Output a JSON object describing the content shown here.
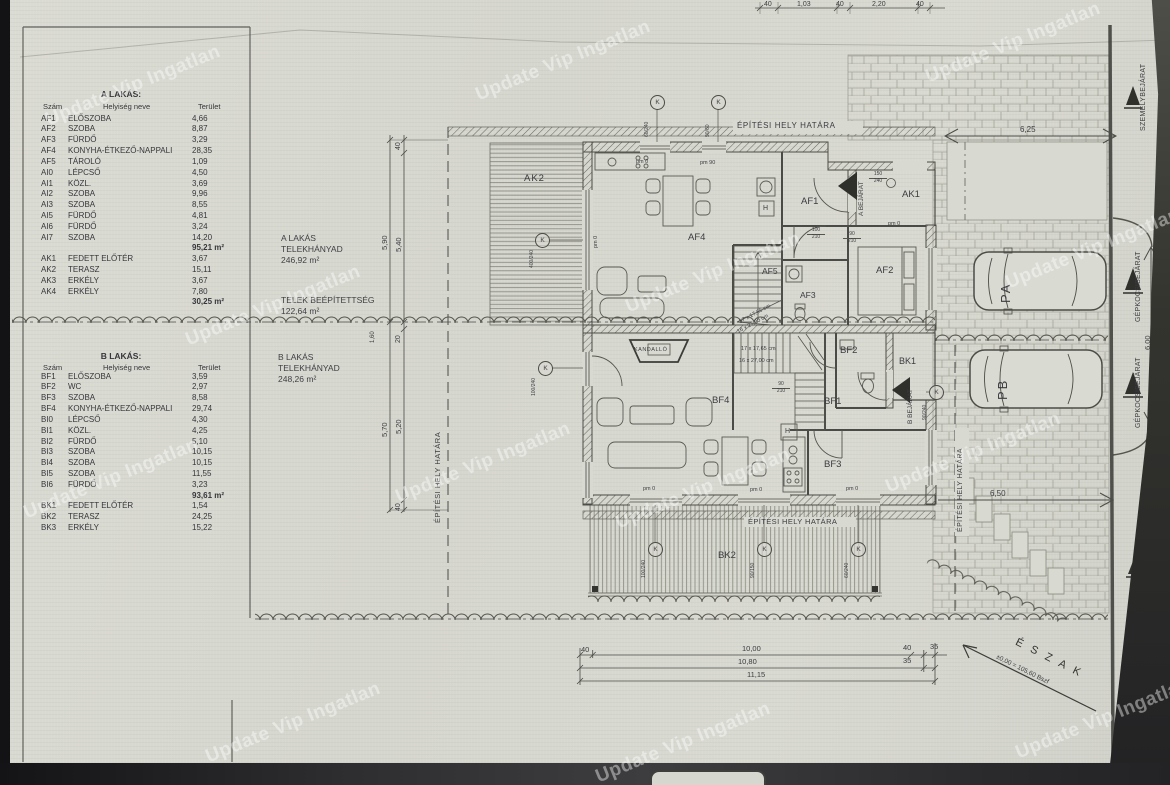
{
  "watermark": "Update Vip Ingatlan",
  "tables": {
    "a": {
      "title": "A LAKÁS:",
      "headers": {
        "num": "Szám",
        "name": "Helyiség neve",
        "area": "Terület"
      },
      "rows": [
        {
          "c": "AF1",
          "n": "ELŐSZOBA",
          "a": "4,66"
        },
        {
          "c": "AF2",
          "n": "SZOBA",
          "a": "8,87"
        },
        {
          "c": "AF3",
          "n": "FÜRDŐ",
          "a": "3,29"
        },
        {
          "c": "AF4",
          "n": "KONYHA-ÉTKEZŐ-NAPPALI",
          "a": "28,35"
        },
        {
          "c": "AF5",
          "n": "TÁROLÓ",
          "a": "1,09"
        },
        {
          "c": "AI0",
          "n": "LÉPCSŐ",
          "a": "4,50"
        },
        {
          "c": "AI1",
          "n": "KÖZL.",
          "a": "3,69"
        },
        {
          "c": "AI2",
          "n": "SZOBA",
          "a": "9,96"
        },
        {
          "c": "AI3",
          "n": "SZOBA",
          "a": "8,55"
        },
        {
          "c": "AI5",
          "n": "FÜRDŐ",
          "a": "4,81"
        },
        {
          "c": "AI6",
          "n": "FÜRDŐ",
          "a": "3,24"
        },
        {
          "c": "AI7",
          "n": "SZOBA",
          "a": "14,20"
        }
      ],
      "subtotal": "95,21 m²",
      "k_rows": [
        {
          "c": "AK1",
          "n": "FEDETT ELŐTÉR",
          "a": "3,67"
        },
        {
          "c": "AK2",
          "n": "TERASZ",
          "a": "15,11"
        },
        {
          "c": "AK3",
          "n": "ERKÉLY",
          "a": "3,67"
        },
        {
          "c": "AK4",
          "n": "ERKÉLY",
          "a": "7,80"
        }
      ],
      "k_subtotal": "30,25 m²"
    },
    "b": {
      "title": "B LAKÁS:",
      "headers": {
        "num": "Szám",
        "name": "Helyiség neve",
        "area": "Terület"
      },
      "rows": [
        {
          "c": "BF1",
          "n": "ELŐSZOBA",
          "a": "3,59"
        },
        {
          "c": "BF2",
          "n": "WC",
          "a": "2,97"
        },
        {
          "c": "BF3",
          "n": "SZOBA",
          "a": "8,58"
        },
        {
          "c": "BF4",
          "n": "KONYHA-ÉTKEZŐ-NAPPALI",
          "a": "29,74"
        },
        {
          "c": "BI0",
          "n": "LÉPCSŐ",
          "a": "4,30"
        },
        {
          "c": "BI1",
          "n": "KÖZL.",
          "a": "4,25"
        },
        {
          "c": "BI2",
          "n": "FÜRDŐ",
          "a": "5,10"
        },
        {
          "c": "BI3",
          "n": "SZOBA",
          "a": "10,15"
        },
        {
          "c": "BI4",
          "n": "SZOBA",
          "a": "10,15"
        },
        {
          "c": "BI5",
          "n": "SZOBA",
          "a": "11,55"
        },
        {
          "c": "BI6",
          "n": "FÜRDŐ",
          "a": "3,23"
        }
      ],
      "subtotal": "93,61 m²",
      "k_rows": [
        {
          "c": "BK1",
          "n": "FEDETT ELŐTÉR",
          "a": "1,54"
        },
        {
          "c": "BK2",
          "n": "TERASZ",
          "a": "24,25"
        },
        {
          "c": "BK3",
          "n": "ERKÉLY",
          "a": "15,22"
        }
      ]
    }
  },
  "annotations": {
    "a_share_l1": "A LAKÁS",
    "a_share_l2": "TELEKHÁNYAD",
    "a_share_val": "246,92 m²",
    "coverage_l1": "TELEK BEÉPÍTETTSÉG",
    "coverage_val": "122,64 m²",
    "b_share_l1": "B LAKÁS",
    "b_share_l2": "TELEKHÁNYAD",
    "b_share_val": "248,26 m²"
  },
  "plan": {
    "boundary": "ÉPÍTÉSI HELY HATÁRA",
    "rooms": {
      "ak2": "AK2",
      "af4": "AF4",
      "af1": "AF1",
      "af5": "AF5",
      "af3": "AF3",
      "af2": "AF2",
      "ak1": "AK1",
      "bf4": "BF4",
      "bf1": "BF1",
      "bf2": "BF2",
      "bf3": "BF3",
      "bk1": "BK1",
      "bk2": "BK2"
    },
    "entrance_a": "A BEJÁRAT",
    "entrance_b": "B BEJÁRAT",
    "fireplace": "KANDALLÓ",
    "h": "H",
    "pm0": "pm 0",
    "pm90": "pm 90",
    "stair_note1": "17 x 17,65 cm",
    "stair_note2": "16 x 27,00 cm",
    "k_letter": "K",
    "window_marks": [
      {
        "v": "60/240"
      },
      {
        "v": "90/60"
      },
      {
        "v": "400/240"
      },
      {
        "v": "100/240"
      },
      {
        "v": "100/240"
      },
      {
        "v": "90/150"
      },
      {
        "v": "60/240"
      },
      {
        "v": "90/240"
      }
    ],
    "door_labels": [
      {
        "a": "100",
        "b": "210"
      },
      {
        "a": "90",
        "b": "210"
      },
      {
        "a": "90",
        "b": "210"
      },
      {
        "a": "150",
        "b": "240"
      }
    ],
    "parking_a": "PA",
    "parking_b": "PB"
  },
  "dims": {
    "top": [
      "40",
      "1,03",
      "40",
      "2,20",
      "40"
    ],
    "left_outer_1": "5,90",
    "left_outer_2": "5,70",
    "left_inner": [
      "40",
      "5,40",
      "20",
      "5,20",
      "40"
    ],
    "left_small": "1,60",
    "d625": "6,25",
    "d650": "6,50",
    "d600": "6,00",
    "b1": [
      "40",
      "10,00",
      "40",
      "35"
    ],
    "b2": [
      "10,80",
      "35"
    ],
    "b3": "11,15"
  },
  "site": {
    "szemely": "SZEMÉLYBEJÁRAT",
    "gepkocsi": "GÉPKOCSIBEJÁRAT",
    "north": "É S Z A K",
    "level": "±0,00 = 105,60 Bszf"
  }
}
